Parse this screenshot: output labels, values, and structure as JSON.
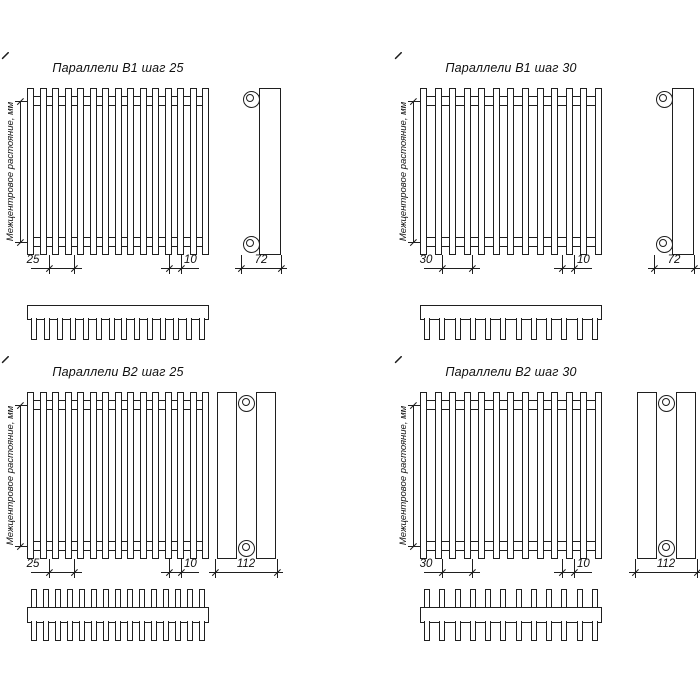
{
  "page": {
    "background": "#ffffff",
    "line_color": "#1f1f1f",
    "text_color": "#101010"
  },
  "shared": {
    "vertical_axis_label": "Межцентровое растояние, мм"
  },
  "quadrants": [
    {
      "id": "b1-step-25",
      "title": "Параллели В1 шаг 25",
      "step_dim": "25",
      "end_dim": "10",
      "depth_dim": "72",
      "tube_rows": 1,
      "front_columns": 15,
      "top_teeth": 14
    },
    {
      "id": "b1-step-30",
      "title": "Параллели В1 шаг 30",
      "step_dim": "30",
      "end_dim": "10",
      "depth_dim": "72",
      "tube_rows": 1,
      "front_columns": 13,
      "top_teeth": 12
    },
    {
      "id": "b2-step-25",
      "title": "Параллели В2 шаг 25",
      "step_dim": "25",
      "end_dim": "10",
      "depth_dim": "112",
      "tube_rows": 2,
      "front_columns": 15,
      "top_teeth": 15
    },
    {
      "id": "b2-step-30",
      "title": "Параллели В2 шаг 30",
      "step_dim": "30",
      "end_dim": "10",
      "depth_dim": "112",
      "tube_rows": 2,
      "front_columns": 13,
      "top_teeth": 12
    }
  ]
}
